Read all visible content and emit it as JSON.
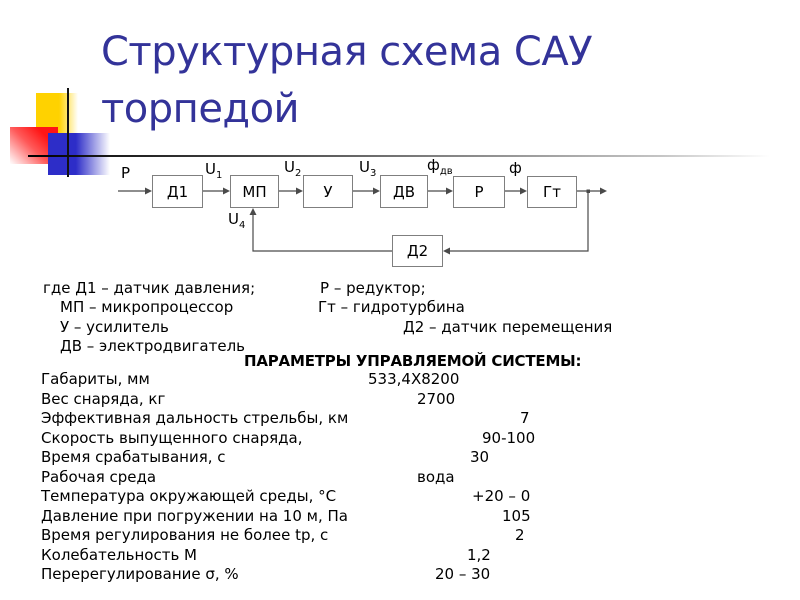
{
  "slide": {
    "title_line1": "Структурная схема САУ",
    "title_line2": "торпедой"
  },
  "colors": {
    "title_text": "#333399",
    "accent_yellow": "#FFD200",
    "accent_red": "#FF1515",
    "accent_blue": "#2D2DC8",
    "box_border": "#7F7F7F",
    "wire": "#4A4A4A",
    "body_text": "#000000"
  },
  "diagram": {
    "blocks": [
      {
        "label": "Д1"
      },
      {
        "label": "МП"
      },
      {
        "label": "У"
      },
      {
        "label": "ДВ"
      },
      {
        "label": "Р"
      },
      {
        "label": "Гт"
      },
      {
        "label": "Д2"
      }
    ],
    "signals": [
      {
        "base": "Р",
        "sub": ""
      },
      {
        "base": "U",
        "sub": "1"
      },
      {
        "base": "U",
        "sub": "2"
      },
      {
        "base": "U",
        "sub": "3"
      },
      {
        "base": "ф",
        "sub": "дв"
      },
      {
        "base": "ф",
        "sub": ""
      },
      {
        "base": "U",
        "sub": "4"
      }
    ]
  },
  "legend": {
    "rows": [
      {
        "left": "где Д1 – датчик давления;",
        "right": "Р – редуктор;"
      },
      {
        "left": "МП – микропроцессор",
        "right": "Гт – гидротурбина"
      },
      {
        "left": "У – усилитель",
        "right": "Д2 – датчик перемещения"
      },
      {
        "left": "ДВ – электродвигатель",
        "right": ""
      }
    ]
  },
  "parameters": {
    "heading": "ПАРАМЕТРЫ УПРАВЛЯЕМОЙ СИСТЕМЫ:",
    "rows": [
      {
        "label": "Габариты, мм",
        "value": "533,4Х8200"
      },
      {
        "label": "Вес снаряда, кг",
        "value": "2700"
      },
      {
        "label": "Эффективная дальность стрельбы, км",
        "value": "7"
      },
      {
        "label": "Скорость выпущенного снаряда,",
        "value": "90-100"
      },
      {
        "label": "Время срабатывания, с",
        "value": "30"
      },
      {
        "label": "Рабочая среда",
        "value": "вода"
      },
      {
        "label": "Температура окружающей среды, °С",
        "value": "+20 – 0"
      },
      {
        "label": "Давление при погружении на 10 м, Па",
        "value": "105"
      },
      {
        "label": "Время регулирования не более tp, с",
        "value": "2"
      },
      {
        "label": "Колебательность М",
        "value": "1,2"
      },
      {
        "label": "Перерегулирование σ, %",
        "value": "20 – 30"
      }
    ]
  }
}
